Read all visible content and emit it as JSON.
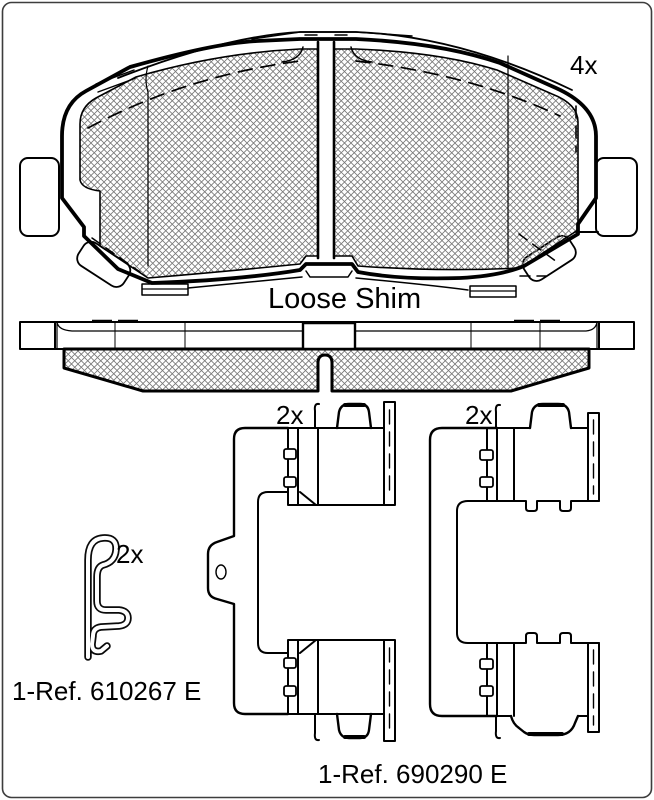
{
  "front_view": {
    "quantity_label": "4x",
    "shim_label": "Loose Shim"
  },
  "hardware": {
    "left_clip": {
      "quantity_label": "2x"
    },
    "right_clip": {
      "quantity_label": "2x"
    },
    "spring_clip": {
      "quantity_label": "2x",
      "ref_label": "1-Ref. 610267 E"
    },
    "kit_ref_label": "1-Ref. 690290 E"
  },
  "colors": {
    "line": "#000000",
    "hatch_line": "#777777",
    "background": "#ffffff",
    "frame_border": "#3d3d3d",
    "text": "#000000"
  }
}
